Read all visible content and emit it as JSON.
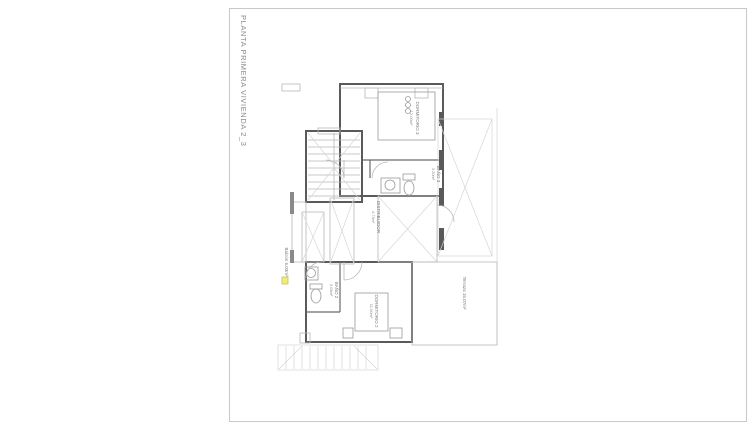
{
  "page": {
    "title": "PLANTA PRIMERA VIVIENDA 2_3"
  },
  "plan": {
    "rooms": {
      "dormitorio3": {
        "name": "DORMITORIO 3",
        "area": "12.00m²"
      },
      "bano3": {
        "name": "BAÑO 3",
        "area": "3.20m²"
      },
      "distribuidor": {
        "name": "DISTRIBUIDOR",
        "area": "4.73m²"
      },
      "bano2": {
        "name": "BAÑO 2",
        "area": "3.05m²"
      },
      "dormitorio2": {
        "name": "DORMITORIO 2",
        "area": "11.00m²"
      },
      "terraza": {
        "name": "Terraza 15.07m²"
      },
      "balcon": {
        "name": "Balcón 6.03m²"
      }
    },
    "colors": {
      "wall": "#5a5a5a",
      "line_light": "#b8b8b8",
      "line_faint": "#d6d6d6",
      "text": "#7a7a7a",
      "sheet_border": "#c9c9c9",
      "marker_yellow": "#f0ec7a"
    }
  }
}
